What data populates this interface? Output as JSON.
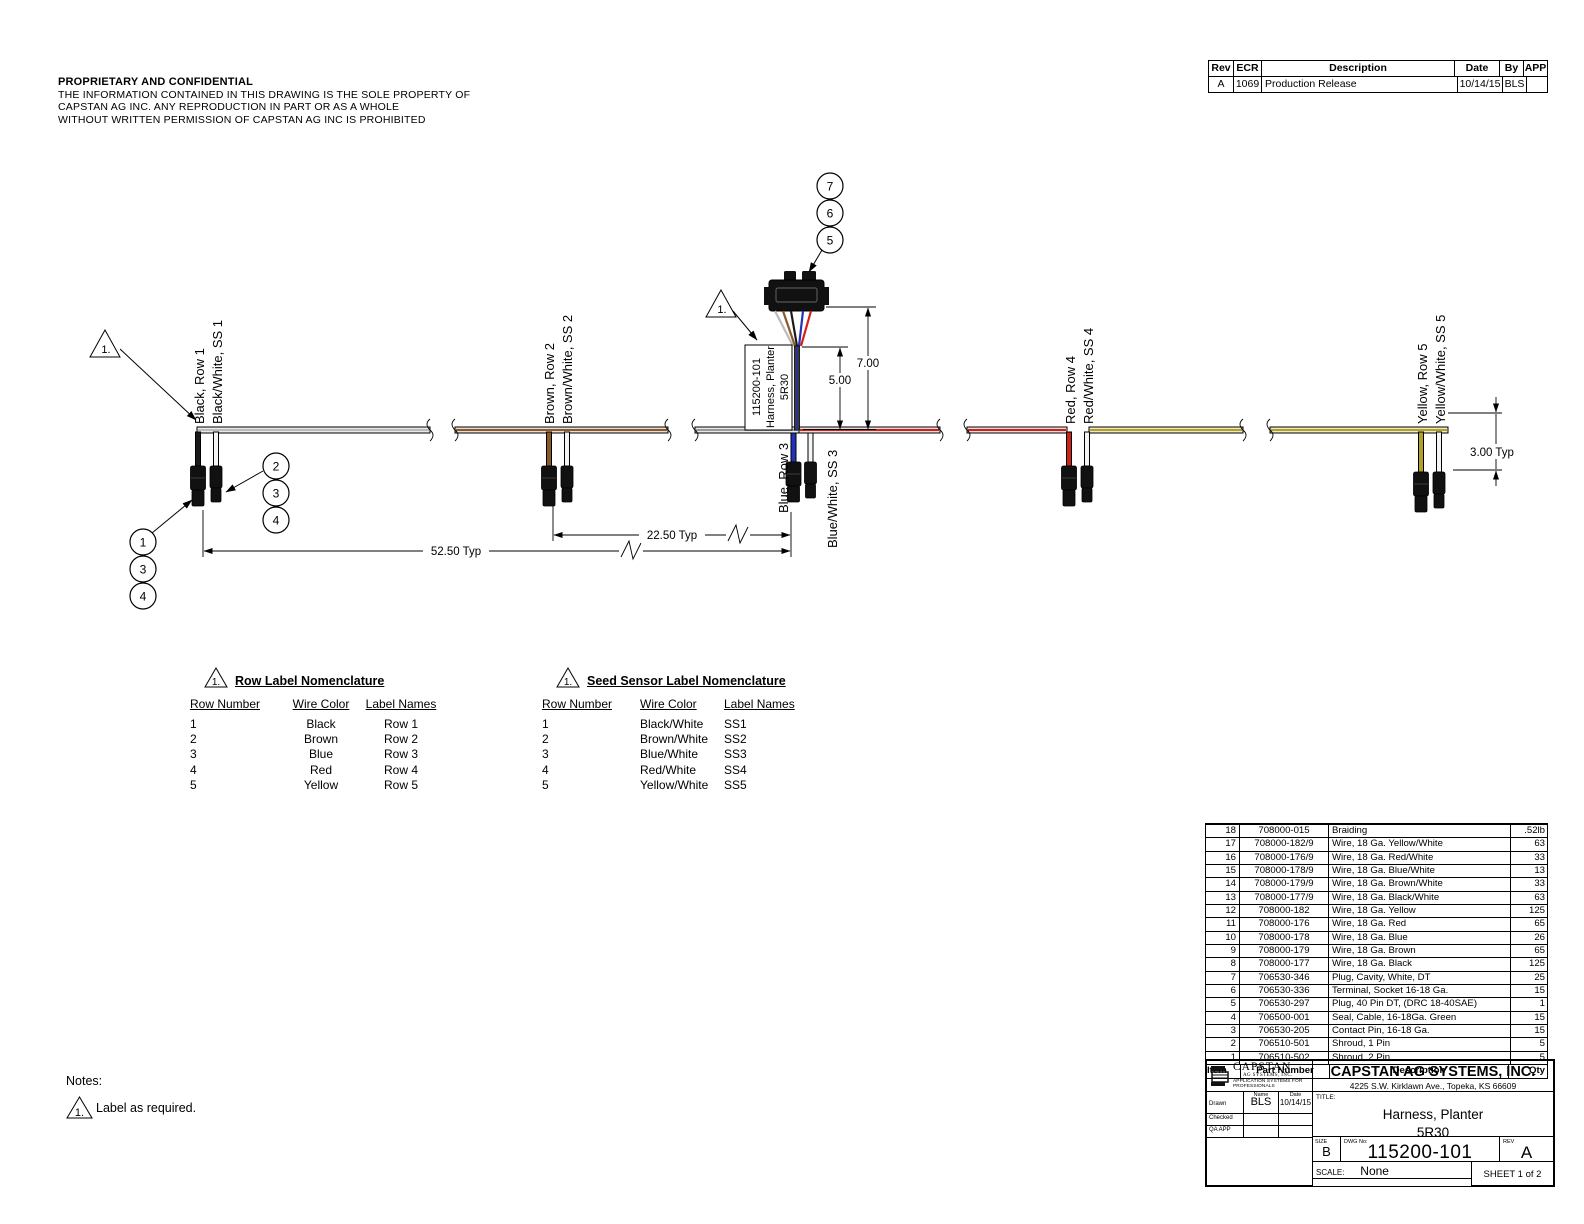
{
  "proprietary": {
    "title": "PROPRIETARY AND CONFIDENTIAL",
    "line1": "THE INFORMATION CONTAINED IN THIS DRAWING IS THE SOLE PROPERTY OF",
    "line2": "CAPSTAN AG INC. ANY REPRODUCTION IN PART OR AS A WHOLE",
    "line3": "WITHOUT WRITTEN PERMISSION OF CAPSTAN AG INC IS PROHIBITED"
  },
  "rev_table": {
    "headers": [
      "Rev",
      "ECR",
      "Description",
      "Date",
      "By",
      "APP"
    ],
    "rows": [
      {
        "rev": "A",
        "ecr": "1069",
        "description": "Production Release",
        "date": "10/14/15",
        "by": "BLS",
        "app": ""
      }
    ]
  },
  "harness": {
    "flag": "1.",
    "part_label": {
      "line1": "115200-101",
      "line2": "Harness, Planter",
      "line3": "5R30"
    },
    "rows": [
      {
        "row_label": "Black, Row 1",
        "ss_label": "Black/White, SS 1"
      },
      {
        "row_label": "Brown, Row 2",
        "ss_label": "Brown/White, SS 2"
      },
      {
        "row_label": "Blue, Row 3",
        "ss_label": "Blue/White, SS 3"
      },
      {
        "row_label": "Red, Row 4",
        "ss_label": "Red/White, SS 4"
      },
      {
        "row_label": "Yellow, Row 5",
        "ss_label": "Yellow/White, SS 5"
      }
    ],
    "dimensions": {
      "d700": "7.00",
      "d500": "5.00",
      "d2250": "22.50 Typ",
      "d5250": "52.50 Typ",
      "d300": "3.00 Typ"
    },
    "balloons": {
      "b7": "7",
      "b6": "6",
      "b5": "5",
      "l1": "1",
      "l3": "3",
      "l4": "4",
      "r2": "2",
      "r3": "3",
      "r4": "4"
    },
    "wire_colors": {
      "black": "#1a1a1a",
      "brown": "#8a5a2b",
      "blue": "#2233bb",
      "red": "#cc2218",
      "yellow": "#b3a125",
      "white": "#f5f5f5",
      "gray": "#bbbbbb"
    }
  },
  "row_nomenclature": {
    "flag": "1.",
    "title": "Row Label Nomenclature",
    "headers": [
      "Row Number",
      "Wire Color",
      "Label Names"
    ],
    "rows": [
      {
        "num": "1",
        "color": "Black",
        "label": "Row 1"
      },
      {
        "num": "2",
        "color": "Brown",
        "label": "Row 2"
      },
      {
        "num": "3",
        "color": "Blue",
        "label": "Row 3"
      },
      {
        "num": "4",
        "color": "Red",
        "label": "Row 4"
      },
      {
        "num": "5",
        "color": "Yellow",
        "label": "Row 5"
      }
    ]
  },
  "sensor_nomenclature": {
    "flag": "1.",
    "title": "Seed Sensor Label Nomenclature",
    "headers": [
      "Row Number",
      "Wire Color",
      "Label Names"
    ],
    "rows": [
      {
        "num": "1",
        "color": "Black/White",
        "label": "SS1"
      },
      {
        "num": "2",
        "color": "Brown/White",
        "label": "SS2"
      },
      {
        "num": "3",
        "color": "Blue/White",
        "label": "SS3"
      },
      {
        "num": "4",
        "color": "Red/White",
        "label": "SS4"
      },
      {
        "num": "5",
        "color": "Yellow/White",
        "label": "SS5"
      }
    ]
  },
  "notes": {
    "title": "Notes:",
    "flag": "1.",
    "note1": "Label as required."
  },
  "bom": {
    "headers": [
      "Item",
      "Part Number",
      "Description",
      "Qty"
    ],
    "rows": [
      {
        "item": "18",
        "part": "708000-015",
        "desc": "Braiding",
        "qty": ".52lb"
      },
      {
        "item": "17",
        "part": "708000-182/9",
        "desc": "Wire, 18 Ga. Yellow/White",
        "qty": "63"
      },
      {
        "item": "16",
        "part": "708000-176/9",
        "desc": "Wire, 18 Ga. Red/White",
        "qty": "33"
      },
      {
        "item": "15",
        "part": "708000-178/9",
        "desc": "Wire, 18 Ga. Blue/White",
        "qty": "13"
      },
      {
        "item": "14",
        "part": "708000-179/9",
        "desc": "Wire, 18 Ga. Brown/White",
        "qty": "33"
      },
      {
        "item": "13",
        "part": "708000-177/9",
        "desc": "Wire, 18 Ga. Black/White",
        "qty": "63"
      },
      {
        "item": "12",
        "part": "708000-182",
        "desc": "Wire, 18 Ga. Yellow",
        "qty": "125"
      },
      {
        "item": "11",
        "part": "708000-176",
        "desc": "Wire, 18 Ga. Red",
        "qty": "65"
      },
      {
        "item": "10",
        "part": "708000-178",
        "desc": "Wire, 18 Ga. Blue",
        "qty": "26"
      },
      {
        "item": "9",
        "part": "708000-179",
        "desc": "Wire, 18 Ga. Brown",
        "qty": "65"
      },
      {
        "item": "8",
        "part": "708000-177",
        "desc": "Wire, 18 Ga. Black",
        "qty": "125"
      },
      {
        "item": "7",
        "part": "706530-346",
        "desc": "Plug, Cavity, White, DT",
        "qty": "25"
      },
      {
        "item": "6",
        "part": "706530-336",
        "desc": "Terminal, Socket 16-18 Ga.",
        "qty": "15"
      },
      {
        "item": "5",
        "part": "706530-297",
        "desc": "Plug, 40 Pin DT, (DRC 18-40SAE)",
        "qty": "1"
      },
      {
        "item": "4",
        "part": "706500-001",
        "desc": "Seal, Cable, 16-18Ga. Green",
        "qty": "15"
      },
      {
        "item": "3",
        "part": "706530-205",
        "desc": "Contact Pin, 16-18 Ga.",
        "qty": "15"
      },
      {
        "item": "2",
        "part": "706510-501",
        "desc": "Shroud, 1 Pin",
        "qty": "5"
      },
      {
        "item": "1",
        "part": "706510-502",
        "desc": "Shroud, 2 Pin",
        "qty": "5"
      }
    ]
  },
  "title_block": {
    "logo_name": "CAPSTAN",
    "logo_sub": "AG SYSTEMS, INC.",
    "logo_tagline": "APPLICATION SYSTEMS FOR PROFESSIONALS",
    "company": "CAPSTAN AG SYSTEMS, INC.",
    "address": "4225 S.W. Kirklawn Ave., Topeka, KS 66609",
    "name_header": "Name",
    "date_header": "Date",
    "drawn_label": "Drawn",
    "checked_label": "Checked",
    "qa_label": "QA APP",
    "drawn_name": "BLS",
    "drawn_date": "10/14/15",
    "title_label": "TITLE:",
    "title_line1": "Harness, Planter",
    "title_line2": "5R30",
    "size_label": "SIZE",
    "size": "B",
    "dwg_label": "DWG No:",
    "dwg_no": "115200-101",
    "rev_label": "REV",
    "rev": "A",
    "scale_label": "SCALE:",
    "scale": "None",
    "sheet": "SHEET 1 of 2"
  }
}
